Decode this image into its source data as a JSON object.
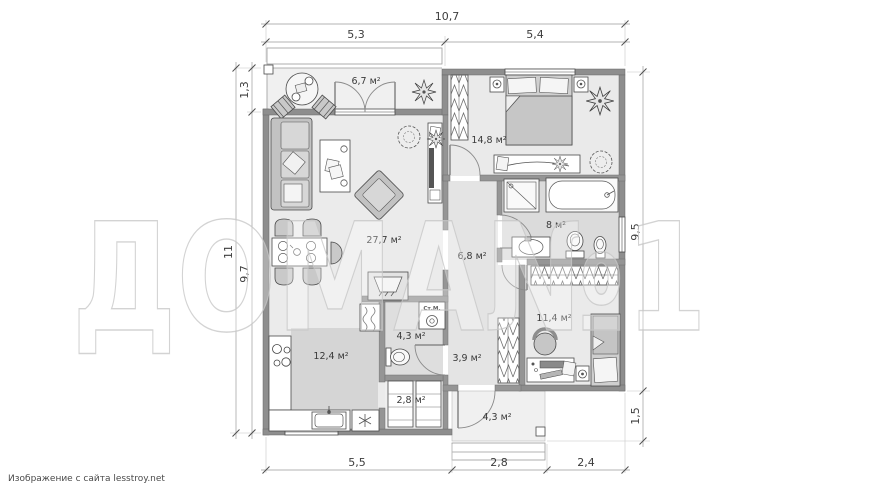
{
  "watermark": {
    "text": "ДОМА№1"
  },
  "credit": "Изображение с сайта lesstroy.net",
  "rooms": {
    "terrace": "6,7 м²",
    "living_room": "27,7 м²",
    "bedroom_1": "14,8 м²",
    "bathroom": "8 м²",
    "hallway": "6,8 м²",
    "wc": "4,3 м²",
    "kitchen": "12,4 м²",
    "pantry": "2,8 м²",
    "entry": "3,9 м²",
    "bedroom_2": "11,4 м²",
    "porch": "4,3 м²"
  },
  "appliances": {
    "washing_machine": "Ст.М."
  },
  "dimensions": {
    "top": {
      "overall": "10,7",
      "segment_left": "5,3",
      "segment_right": "5,4"
    },
    "left": {
      "overall": "11",
      "terrace_depth": "1,3",
      "house_depth": "9,7"
    },
    "right": {
      "house_depth": "9,5",
      "porch_depth": "1,5"
    },
    "bottom": {
      "segment_left": "5,5",
      "segment_center": "2,8",
      "segment_right": "2,4"
    }
  },
  "colors": {
    "wall": "#8e8e8e",
    "floor_light": "#ebebeb",
    "floor_wet": "#dcdcdc",
    "fixture": "#ffffff",
    "dimension_text": "#3d3d3d"
  }
}
